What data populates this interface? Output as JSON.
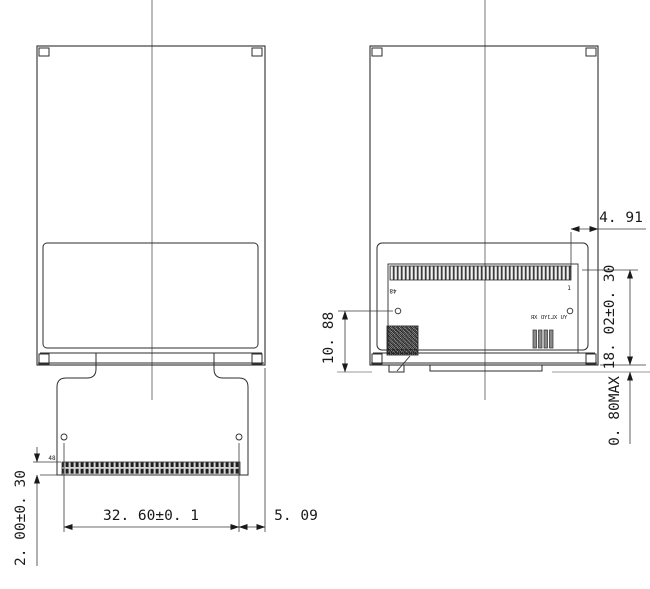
{
  "drawing": {
    "front_view": {
      "pin_label": "48",
      "dims": {
        "connector_width": "32. 60±0. 1",
        "right_offset": "5. 09",
        "fpc_thickness": "2. 00±0. 30"
      }
    },
    "back_view": {
      "pin_label_left": "48",
      "pin_label_right": "1",
      "marking_text": "YU XLJYD XR",
      "dims": {
        "pin_to_edge": "4. 91",
        "hole_to_bottom": "10. 88",
        "pcb_height": "18. 02±0. 30",
        "protrusion": "0. 80MAX"
      }
    },
    "colors": {
      "line": "#2e2e2e",
      "dimension_line": "#3a3a3a",
      "centerline": "#555555",
      "reference_line": "#9a9a9a",
      "background": "#ffffff"
    }
  }
}
